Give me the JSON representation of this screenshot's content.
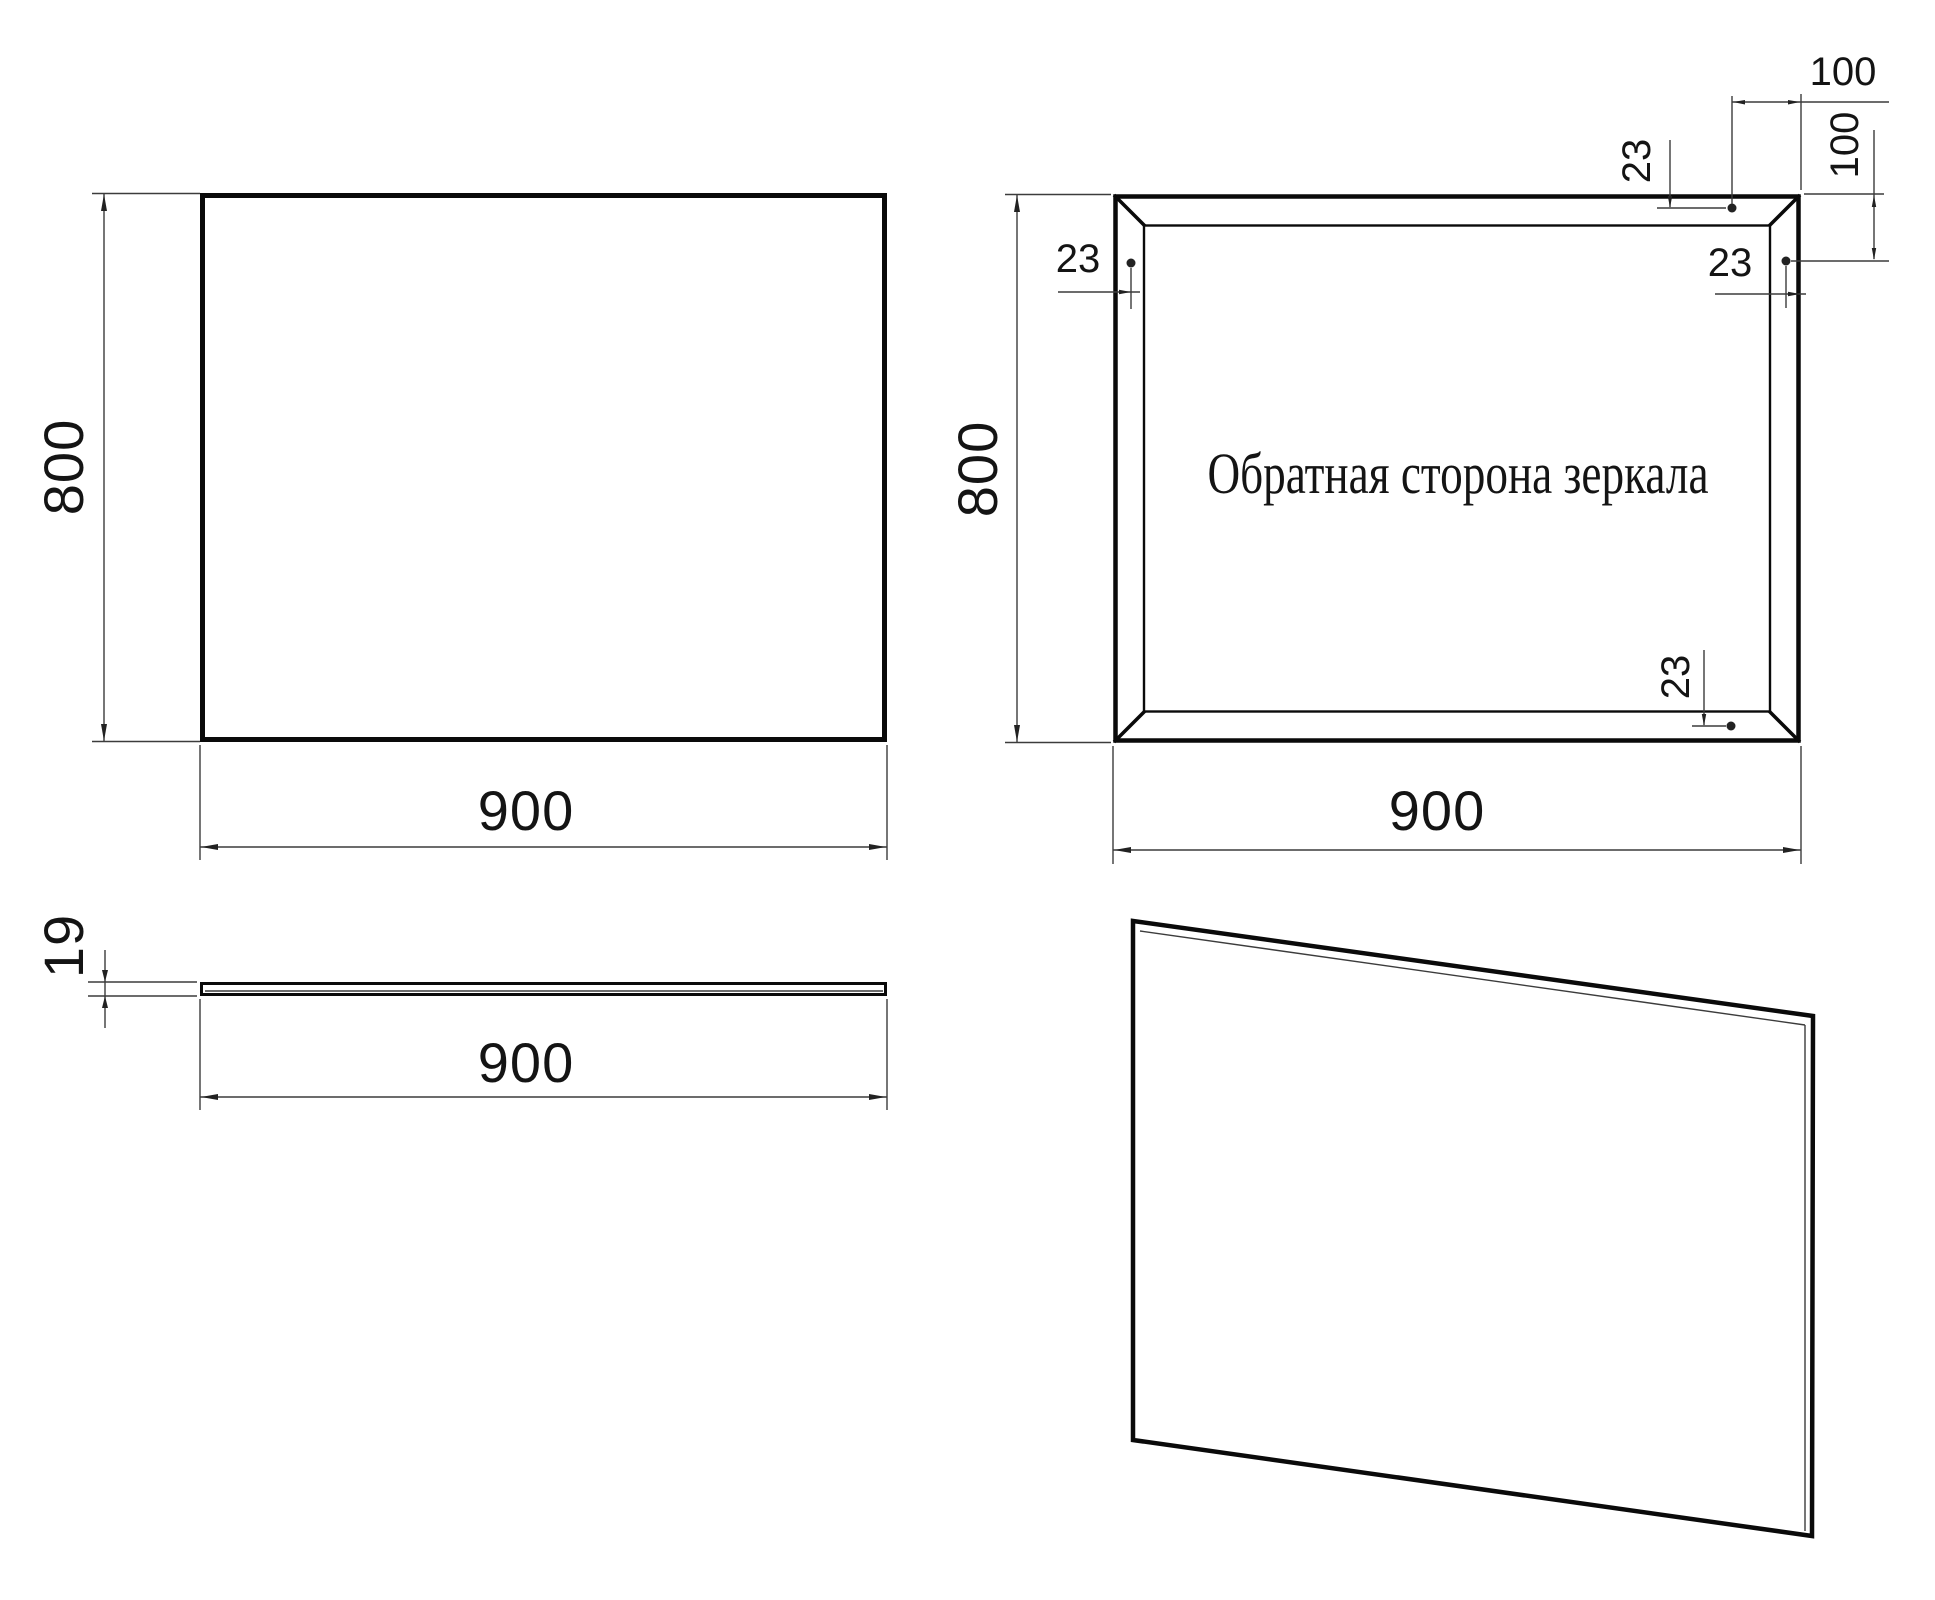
{
  "front_view": {
    "height_label": "800",
    "width_label": "900"
  },
  "back_view": {
    "label": "Обратная сторона зеркала",
    "height_label": "800",
    "width_label": "900",
    "top_point_edge_offset": "23",
    "left_point_edge_offset": "23",
    "right_point_edge_offset": "23",
    "bottom_point_edge_offset": "23",
    "top_point_inset": "100",
    "right_point_inset": "100"
  },
  "side_view": {
    "thickness_label": "19",
    "width_label": "900"
  },
  "colors": {
    "line": "#0a0a0a",
    "dim_line": "#3c3c3c",
    "background": "#ffffff"
  }
}
